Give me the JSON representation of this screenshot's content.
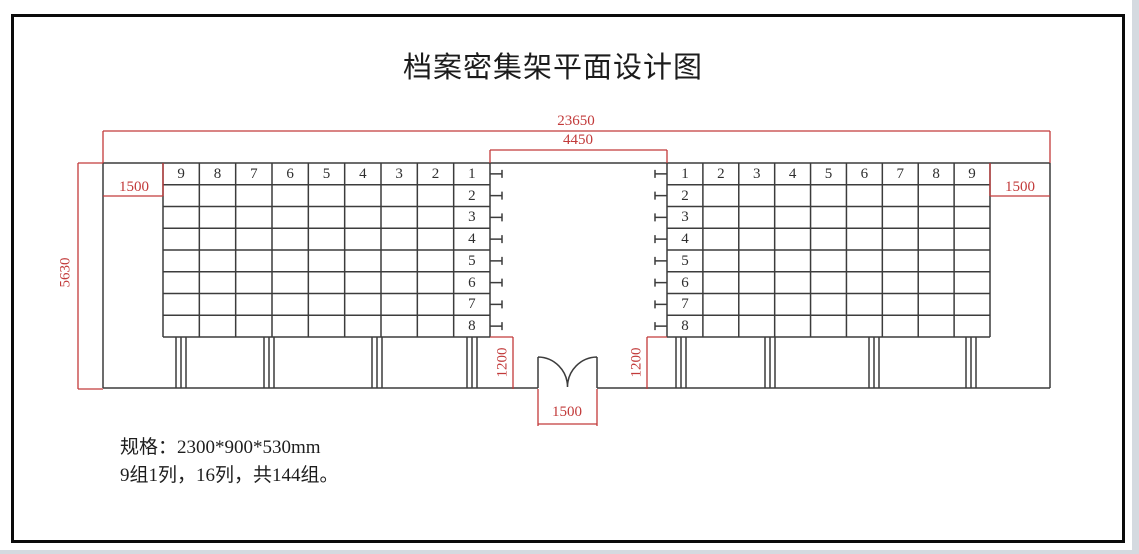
{
  "title": "档案密集架平面设计图",
  "dimensions": {
    "total_width": "23650",
    "center_aisle": "4450",
    "side_aisle_left": "1500",
    "side_aisle_right": "1500",
    "room_depth": "5630",
    "front_gap_left": "1200",
    "front_gap_right": "1200",
    "door_width": "1500"
  },
  "left_grid": {
    "header": [
      "9",
      "8",
      "7",
      "6",
      "5",
      "4",
      "3",
      "2",
      "1"
    ],
    "row_labels": [
      "2",
      "3",
      "4",
      "5",
      "6",
      "7",
      "8"
    ]
  },
  "right_grid": {
    "header": [
      "1",
      "2",
      "3",
      "4",
      "5",
      "6",
      "7",
      "8",
      "9"
    ],
    "row_labels": [
      "2",
      "3",
      "4",
      "5",
      "6",
      "7",
      "8"
    ]
  },
  "notes": {
    "line1": "规格：2300*900*530mm",
    "line2": "9组1列，16列，共144组。"
  },
  "colors": {
    "dimension_red": "#c23a3a",
    "line_dark": "#3c3c3c"
  }
}
